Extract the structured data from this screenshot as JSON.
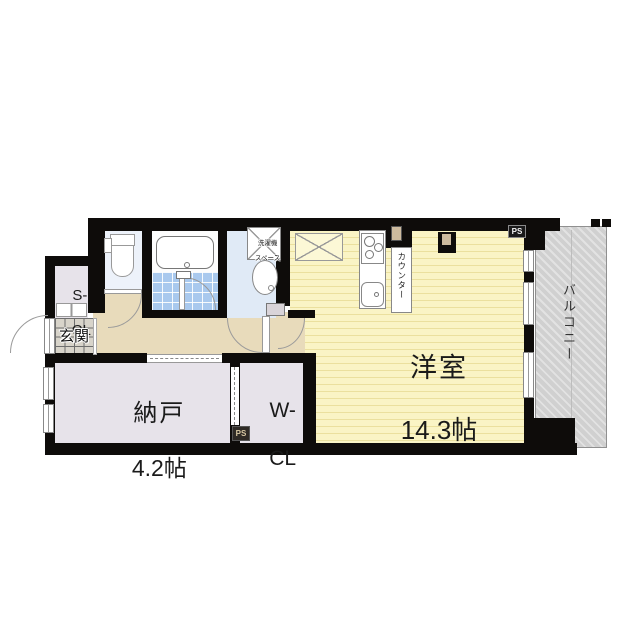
{
  "plan_title": "apartment-floor-plan",
  "rooms": {
    "western": {
      "name": "洋室",
      "area": "14.3帖"
    },
    "storage": {
      "name": "納戸",
      "area": "4.2帖"
    },
    "walk_in_closet": {
      "line1": "W-",
      "line2": "CL"
    },
    "shoe_closet": {
      "line1": "S-",
      "line2": "CL"
    },
    "entrance": {
      "name": "玄関"
    },
    "balcony": {
      "name": "バルコニー"
    },
    "counter": {
      "name": "カウンター"
    },
    "laundry_space": {
      "line1": "洗濯機",
      "line2": "スペース"
    }
  },
  "shafts": {
    "ps_top": "PS",
    "ps_bottom": "PS"
  },
  "colors": {
    "wall": "#0e0c0a",
    "western_room_floor": "#faf4c5",
    "corridor_floor": "#e8dbbb",
    "closet_floor": "#e7e3ea",
    "bath_tile": "#a9c9ee",
    "powder_floor": "#e0eaf6",
    "toilet_floor": "#edf2fa",
    "entrance_tile": "#d8d4ca",
    "balcony": "#d0d0d0"
  }
}
